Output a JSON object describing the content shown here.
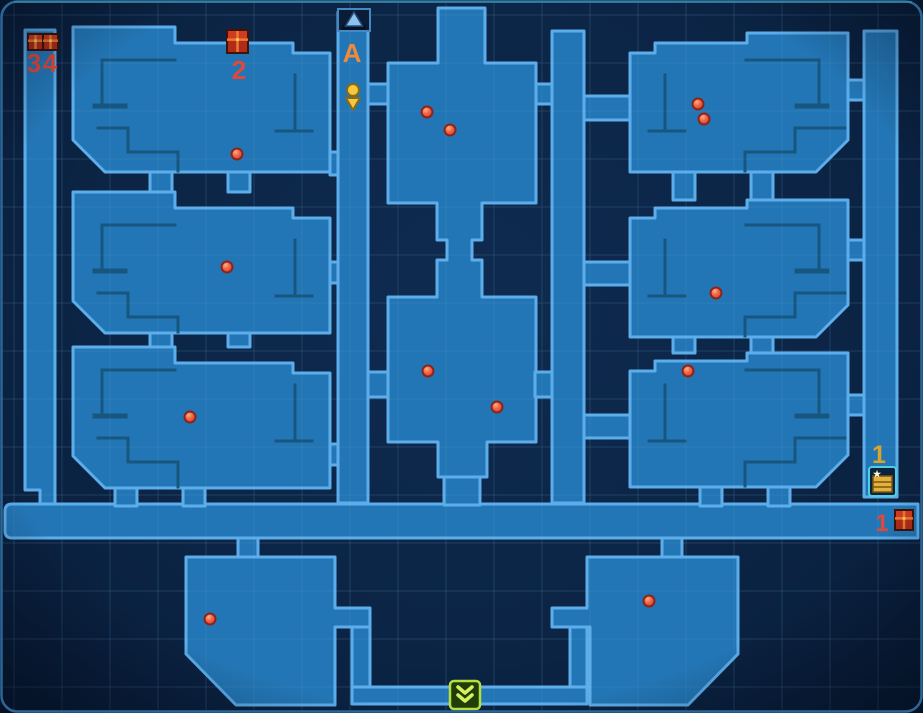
{
  "map": {
    "width": 923,
    "height": 713,
    "grid": {
      "spacing": 48,
      "ox": 14,
      "oy": 15
    },
    "palette": {
      "grid": "#1c4068",
      "grid_top": "#bfe0f5",
      "room_fill": "#2376b5",
      "room_stroke": "#5cadea",
      "detail": "#17567f",
      "frame": "#2c6697",
      "top_glow": "#3fa0ac",
      "enemy_fill": "#f08050",
      "enemy_core": "#e04830",
      "enemy_stroke": "#8c241c",
      "chest_body": "#b02c18",
      "chest_trim": "#ee7a30",
      "chest_dark": "#401208",
      "gold": "#e3b13c",
      "gold_dark": "#7a5810",
      "cyan": "#4ecfdc",
      "exit_green": "#b7dd3f",
      "exit_dark": "#203e08",
      "exit_glyph": "#d6f060",
      "portal_fill": "#0a1c38",
      "portal_stroke": "#4688c0",
      "portal_tri": "#8cc4ee",
      "pin": "#f5c93e",
      "pin_stroke": "#8a6a14"
    },
    "rooms": [
      {
        "n": "left-corridor",
        "d": "M25,30 H55 V508 H40 V490 H25 Z"
      },
      {
        "n": "main-corridor",
        "d": "M12,504 H918 V538 H12 Q5,538 5,531 V511 Q5,504 12,504 Z"
      },
      {
        "n": "bottom-left-room",
        "d": "M186,557 H335 V608 H370 V627 H335 V705 H236 L186,654 Z"
      },
      {
        "n": "door",
        "d": "M238,538 H258 V557 H238 Z"
      },
      {
        "n": "bottom-left-shaft",
        "d": "M352,627 H370 V687 H352 Z"
      },
      {
        "n": "bottom-exit-corridor",
        "d": "M352,687 H587 V704 H352 Z"
      },
      {
        "n": "bottom-right-room",
        "d": "M587,557 H738 V654 L688,705 H590 V627 H552 V608 H587 Z"
      },
      {
        "n": "door",
        "d": "M662,538 H682 V557 H662 Z"
      },
      {
        "n": "bottom-right-shaft",
        "d": "M570,627 H587 V687 H570 Z"
      },
      {
        "n": "room-left-1",
        "d": "M73,27 H175 V43 H293 V53 H330 V172 H105 L73,140 Z"
      },
      {
        "n": "room-left-2",
        "d": "M73,192 H175 V208 H293 V218 H330 V333 H105 L73,301 Z"
      },
      {
        "n": "room-left-3",
        "d": "M73,347 H175 V363 H293 V373 H330 V488 H105 L73,456 Z"
      },
      {
        "n": "door",
        "d": "M150,172 H172 V192 H150 Z"
      },
      {
        "n": "door",
        "d": "M228,172 H250 V192 H228 Z"
      },
      {
        "n": "door",
        "d": "M150,333 H172 V347 H150 Z"
      },
      {
        "n": "door",
        "d": "M228,333 H250 V347 H228 Z"
      },
      {
        "n": "door",
        "d": "M115,488 H137 V506 H115 Z"
      },
      {
        "n": "door",
        "d": "M183,488 H205 V506 H183 Z"
      },
      {
        "n": "door",
        "d": "M330,152 H340 V175 H330 Z"
      },
      {
        "n": "door",
        "d": "M330,262 H340 V283 H330 Z"
      },
      {
        "n": "door",
        "d": "M330,444 H340 V465 H330 Z"
      },
      {
        "n": "entrance-shaft",
        "d": "M338,12 H368 V503 H338 Z"
      },
      {
        "n": "door",
        "d": "M368,84 H390 V104 H368 Z"
      },
      {
        "n": "door",
        "d": "M368,372 H390 V397 H368 Z"
      },
      {
        "n": "center-rooms",
        "d": "M438,8 H485 V63 H536 V203 H482 V240 H472 V260 H482 V297 H536 V442 H487 V477 H438 V442 H388 V297 H437 V260 H447 V240 H437 V203 H388 V63 H438 Z"
      },
      {
        "n": "door",
        "d": "M444,477 H480 V505 H444 Z"
      },
      {
        "n": "center-right-shaft",
        "d": "M552,31 H584 V503 H552 Z"
      },
      {
        "n": "door",
        "d": "M536,84 H552 V104 H536 Z"
      },
      {
        "n": "door",
        "d": "M535,372 H552 V397 H535 Z"
      },
      {
        "n": "door",
        "d": "M584,96 H630 V120 H584 Z"
      },
      {
        "n": "door",
        "d": "M584,262 H630 V285 H584 Z"
      },
      {
        "n": "door",
        "d": "M584,415 H630 V438 H584 Z"
      },
      {
        "n": "room-right-1",
        "d": "M630,53 H655 V43 H747 V33 H848 V140 L816,172 H630 Z"
      },
      {
        "n": "room-right-2",
        "d": "M630,218 H655 V208 H747 V200 H848 V305 L816,337 H630 Z"
      },
      {
        "n": "room-right-3",
        "d": "M630,371 H655 V361 H747 V353 H848 V455 L816,487 H630 Z"
      },
      {
        "n": "door",
        "d": "M673,172 H695 V200 H673 Z"
      },
      {
        "n": "door",
        "d": "M751,172 H773 V200 H751 Z"
      },
      {
        "n": "door",
        "d": "M673,337 H695 V353 H673 Z"
      },
      {
        "n": "door",
        "d": "M751,337 H773 V353 H751 Z"
      },
      {
        "n": "door",
        "d": "M700,487 H722 V506 H700 Z"
      },
      {
        "n": "door",
        "d": "M768,487 H790 V506 H768 Z"
      },
      {
        "n": "door",
        "d": "M848,80 H864 V100 H848 Z"
      },
      {
        "n": "door",
        "d": "M848,240 H864 V260 H848 Z"
      },
      {
        "n": "door",
        "d": "M848,395 H864 V415 H848 Z"
      },
      {
        "n": "right-corridor",
        "d": "M864,31 H897 V497 H864 Z"
      }
    ],
    "details": [
      {
        "d": "M102,103 V60 H175"
      },
      {
        "d": "M295,75 V128"
      },
      {
        "d": "M276,131 H312"
      },
      {
        "d": "M98,128 H128 V152 H178 V171"
      },
      {
        "d": "M95,106 H125",
        "w": 5
      },
      {
        "d": "M102,268 V225 H175"
      },
      {
        "d": "M295,240 V293"
      },
      {
        "d": "M276,296 H312"
      },
      {
        "d": "M98,293 H128 V317 H178 V332"
      },
      {
        "d": "M95,271 H125",
        "w": 5
      },
      {
        "d": "M102,413 V370 H175"
      },
      {
        "d": "M295,385 V438"
      },
      {
        "d": "M276,441 H312"
      },
      {
        "d": "M98,438 H128 V462 H178 V487"
      },
      {
        "d": "M95,416 H125",
        "w": 5
      },
      {
        "d": "M819,103 V60 H746"
      },
      {
        "d": "M665,75 V128"
      },
      {
        "d": "M649,131 H685"
      },
      {
        "d": "M845,128 H795 V152 H745 V171"
      },
      {
        "d": "M797,106 H827",
        "w": 5
      },
      {
        "d": "M819,268 V225 H746"
      },
      {
        "d": "M665,240 V293"
      },
      {
        "d": "M649,296 H685"
      },
      {
        "d": "M845,293 H795 V317 H745 V336"
      },
      {
        "d": "M797,271 H827",
        "w": 5
      },
      {
        "d": "M819,413 V370 H746"
      },
      {
        "d": "M665,385 V438"
      },
      {
        "d": "M649,441 H685"
      },
      {
        "d": "M845,438 H795 V462 H745 V486"
      },
      {
        "d": "M797,416 H827",
        "w": 5
      }
    ]
  },
  "markers": {
    "enemies": [
      [
        237,
        154
      ],
      [
        227,
        267
      ],
      [
        190,
        417
      ],
      [
        427,
        112
      ],
      [
        450,
        130
      ],
      [
        698,
        104
      ],
      [
        704,
        119
      ],
      [
        716,
        293
      ],
      [
        428,
        371
      ],
      [
        497,
        407
      ],
      [
        688,
        371
      ],
      [
        210,
        619
      ],
      [
        649,
        601
      ]
    ],
    "red_chests": [
      {
        "x": 28,
        "y": 34,
        "w": 15,
        "h": 16
      },
      {
        "x": 43,
        "y": 34,
        "w": 15,
        "h": 16
      },
      {
        "x": 227,
        "y": 30,
        "w": 21,
        "h": 23
      },
      {
        "x": 895,
        "y": 510,
        "w": 18,
        "h": 20
      }
    ],
    "entrance_portal": {
      "box": [
        338,
        9,
        32,
        22
      ],
      "tri": "354,12 345.5,26 362.5,26"
    },
    "player": {
      "cx": 353,
      "cy": 90,
      "r": 6,
      "tri": "346,98 360,98 353,110"
    },
    "special_chest": {
      "box": [
        869,
        467,
        27,
        29
      ]
    },
    "exit_door": {
      "box": [
        450,
        681,
        30,
        28
      ]
    },
    "labels": [
      {
        "text": "3",
        "x": 34,
        "y": 72,
        "color": "#e0483a",
        "size": 26,
        "name": "chest-3-count-label"
      },
      {
        "text": "4",
        "x": 50,
        "y": 72,
        "color": "#e0483a",
        "size": 26,
        "name": "chest-4-count-label"
      },
      {
        "text": "2",
        "x": 239,
        "y": 79,
        "color": "#e0483a",
        "size": 26,
        "name": "chest-2-count-label"
      },
      {
        "text": "A",
        "x": 352,
        "y": 62,
        "color": "#ef8a3a",
        "size": 26,
        "name": "entrance-label"
      },
      {
        "text": "1",
        "x": 879,
        "y": 463,
        "color": "#dba426",
        "size": 25,
        "name": "special-chest-count-label"
      },
      {
        "text": "1",
        "x": 882,
        "y": 531,
        "color": "#e0483a",
        "size": 24,
        "name": "corridor-chest-count-label"
      }
    ]
  }
}
